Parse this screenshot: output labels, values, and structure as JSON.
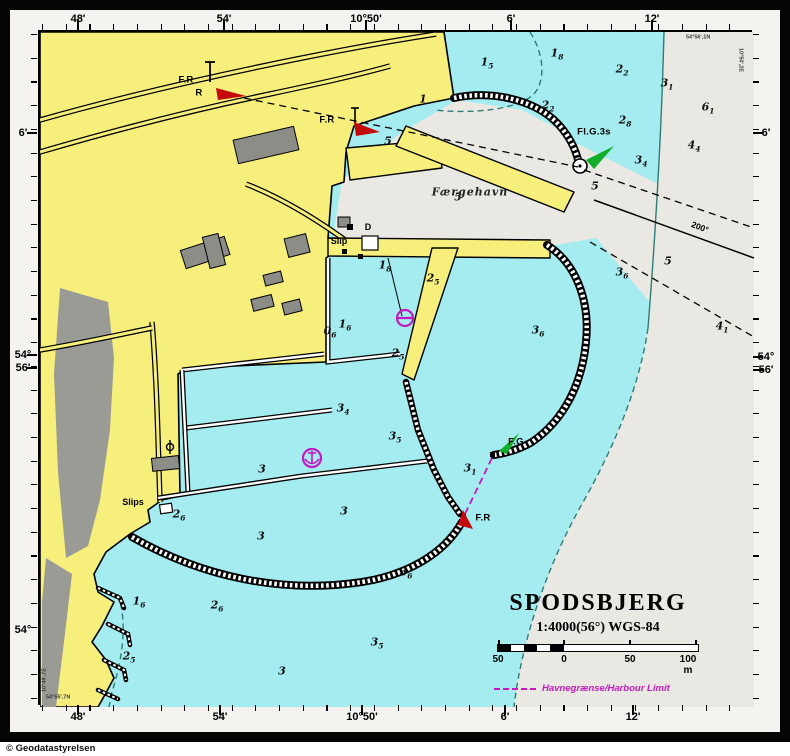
{
  "chart": {
    "title": "SPODSBJERG",
    "scale_line": "1:4000(56°) WGS-84",
    "copyright": "© Geodatastyrelsen",
    "scalebar": {
      "left": "50",
      "zero": "0",
      "right": "50",
      "end": "100 m"
    },
    "legend": {
      "harbour_limit": "Havnegrænse/Harbour Limit"
    }
  },
  "colors": {
    "land": "#f7ef7c",
    "shallow": "#a4ecf0",
    "deep": "#e9e8e3",
    "cliff": "#9b9b96",
    "building": "#8d8d88",
    "magenta": "#c419c0",
    "red": "#c40a0a",
    "green": "#0fae2b",
    "contour": "#2e7d74"
  },
  "corner_coords": {
    "top_right_lat": "54°56',1N",
    "top_right_lon": "10°50',2E",
    "bottom_left_lat": "54°55',7N",
    "bottom_left_lon": "10°49',7E"
  },
  "edge_labels": {
    "top": [
      {
        "t": "48'",
        "x": 78
      },
      {
        "t": "54'",
        "x": 224
      },
      {
        "t": "10°50'",
        "x": 366
      },
      {
        "t": "6'",
        "x": 511
      },
      {
        "t": "12'",
        "x": 652
      }
    ],
    "bottom": [
      {
        "t": "48'",
        "x": 78
      },
      {
        "t": "54'",
        "x": 220
      },
      {
        "t": "10°50'",
        "x": 362
      },
      {
        "t": "6'",
        "x": 505
      },
      {
        "t": "12'",
        "x": 633
      }
    ],
    "left": [
      {
        "t": "6'",
        "y": 133
      },
      {
        "t": "54°",
        "y": 355
      },
      {
        "t": "56'",
        "y": 368
      },
      {
        "t": "54°",
        "y": 630
      }
    ],
    "right": [
      {
        "t": "6'",
        "y": 133
      },
      {
        "t": "54°",
        "y": 357
      },
      {
        "t": "56'",
        "y": 370
      }
    ]
  },
  "lights": [
    {
      "name": "light-label-north-west-fr",
      "text": "F.R",
      "x": 186,
      "y": 80
    },
    {
      "name": "light-label-north-west-r",
      "text": "R",
      "x": 199,
      "y": 93
    },
    {
      "name": "light-label-inner-fr",
      "text": "F.R",
      "x": 327,
      "y": 120
    },
    {
      "name": "light-label-flg3s",
      "text": "Fl.G.3s",
      "x": 594,
      "y": 132
    },
    {
      "name": "light-label-fg",
      "text": "F.G",
      "x": 516,
      "y": 442
    },
    {
      "name": "light-label-south-fr",
      "text": "F.R",
      "x": 483,
      "y": 518
    }
  ],
  "misc_labels": [
    {
      "name": "ferry-harbour-label",
      "text": "Færgehavn",
      "x": 470,
      "y": 192,
      "cls": "ferry-label"
    },
    {
      "name": "slip-label-north",
      "text": "Slip",
      "x": 339,
      "y": 241,
      "cls": "misc-label"
    },
    {
      "name": "dolphin-label",
      "text": "D",
      "x": 368,
      "y": 227,
      "cls": "misc-label"
    },
    {
      "name": "slips-label-south",
      "text": "Slips",
      "x": 133,
      "y": 502,
      "cls": "misc-label"
    },
    {
      "name": "bearing-label",
      "text": "200°",
      "x": 700,
      "y": 227,
      "cls": "rot200"
    }
  ],
  "soundings": [
    {
      "x": 487,
      "y": 63,
      "v": "1",
      "s": "5"
    },
    {
      "x": 557,
      "y": 54,
      "v": "1",
      "s": "8"
    },
    {
      "x": 622,
      "y": 70,
      "v": "2",
      "s": "2"
    },
    {
      "x": 667,
      "y": 84,
      "v": "3",
      "s": "1"
    },
    {
      "x": 708,
      "y": 108,
      "v": "6",
      "s": "1"
    },
    {
      "x": 694,
      "y": 146,
      "v": "4",
      "s": "4"
    },
    {
      "x": 548,
      "y": 106,
      "v": "2",
      "s": "2"
    },
    {
      "x": 625,
      "y": 121,
      "v": "2",
      "s": "8"
    },
    {
      "x": 641,
      "y": 161,
      "v": "3",
      "s": "4"
    },
    {
      "x": 388,
      "y": 141,
      "v": "5",
      "s": ""
    },
    {
      "x": 458,
      "y": 197,
      "v": "5",
      "s": ""
    },
    {
      "x": 595,
      "y": 186,
      "v": "5",
      "s": ""
    },
    {
      "x": 668,
      "y": 261,
      "v": "5",
      "s": ""
    },
    {
      "x": 423,
      "y": 99,
      "v": "1",
      "s": ""
    },
    {
      "x": 385,
      "y": 266,
      "v": "1",
      "s": "8"
    },
    {
      "x": 433,
      "y": 279,
      "v": "2",
      "s": "5"
    },
    {
      "x": 345,
      "y": 325,
      "v": "1",
      "s": "6"
    },
    {
      "x": 330,
      "y": 332,
      "v": "0",
      "s": "6"
    },
    {
      "x": 398,
      "y": 354,
      "v": "2",
      "s": "5"
    },
    {
      "x": 538,
      "y": 331,
      "v": "3",
      "s": "6"
    },
    {
      "x": 622,
      "y": 273,
      "v": "3",
      "s": "6"
    },
    {
      "x": 343,
      "y": 409,
      "v": "3",
      "s": "4"
    },
    {
      "x": 395,
      "y": 437,
      "v": "3",
      "s": "5"
    },
    {
      "x": 470,
      "y": 469,
      "v": "3",
      "s": "1"
    },
    {
      "x": 262,
      "y": 469,
      "v": "3",
      "s": ""
    },
    {
      "x": 261,
      "y": 536,
      "v": "3",
      "s": ""
    },
    {
      "x": 344,
      "y": 511,
      "v": "3",
      "s": ""
    },
    {
      "x": 179,
      "y": 515,
      "v": "2",
      "s": "6"
    },
    {
      "x": 139,
      "y": 602,
      "v": "1",
      "s": "6"
    },
    {
      "x": 217,
      "y": 606,
      "v": "2",
      "s": "6"
    },
    {
      "x": 129,
      "y": 657,
      "v": "2",
      "s": "5"
    },
    {
      "x": 406,
      "y": 573,
      "v": "3",
      "s": "6"
    },
    {
      "x": 377,
      "y": 643,
      "v": "3",
      "s": "5"
    },
    {
      "x": 282,
      "y": 671,
      "v": "3",
      "s": ""
    },
    {
      "x": 722,
      "y": 327,
      "v": "4",
      "s": "1"
    }
  ]
}
